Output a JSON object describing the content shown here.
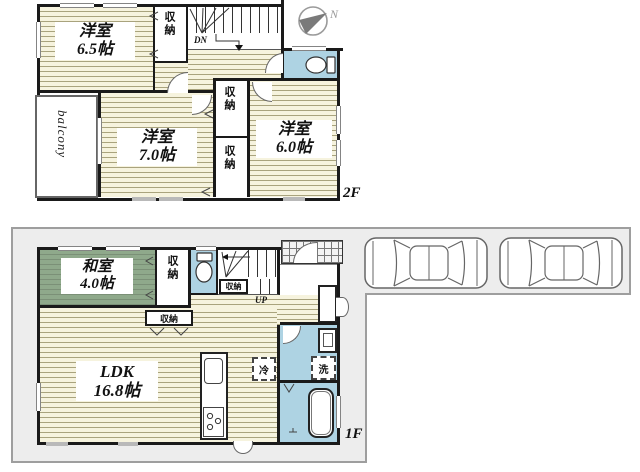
{
  "compass": {
    "north_label": "N"
  },
  "colors": {
    "wall": "#1a1a1a",
    "wood_floor": "#f6f3de",
    "wood_stripe": "#a9a37d",
    "tatami": "#8fa98b",
    "wet_area": "#aed3e3",
    "plot_fill": "#ededed",
    "plot_line": "#9e9e9e",
    "car_outline": "#666666"
  },
  "floor2": {
    "floor_label": "2F",
    "bedroom1": {
      "name": "洋室",
      "size": "6.5帖"
    },
    "bedroom2": {
      "name": "洋室",
      "size": "7.0帖"
    },
    "bedroom3": {
      "name": "洋室",
      "size": "6.0帖"
    },
    "closet_top": "収納",
    "closet_mid": "収納",
    "closet_bottom": "収納",
    "balcony_label": "balcony",
    "stairs_down_label": "DN"
  },
  "floor1": {
    "floor_label": "1F",
    "japanese_room": {
      "name": "和室",
      "size": "4.0帖"
    },
    "ldk": {
      "name": "LDK",
      "size": "16.8帖"
    },
    "closet_side": "収納",
    "closet_under_stairs": "収納",
    "closet_ldk": "収納",
    "stairs_up_label": "UP",
    "fridge_label": "冷",
    "washer_label": "洗"
  }
}
